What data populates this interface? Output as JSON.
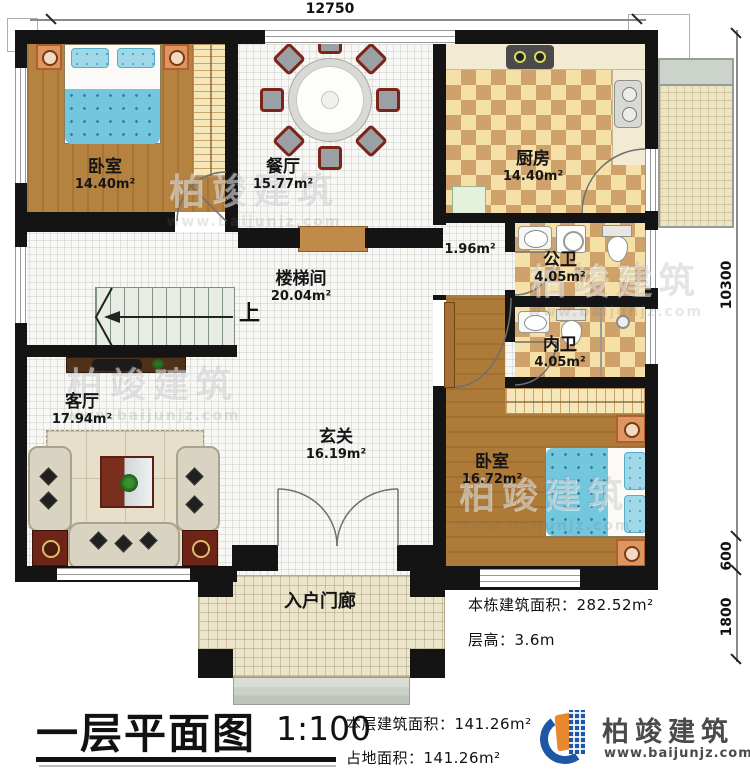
{
  "plan": {
    "dimensions": {
      "top": "12750",
      "right_total": "10300",
      "right_600": "600",
      "right_1800": "1800"
    },
    "stairs_up_label": "上",
    "rooms": {
      "bedroom1": {
        "name": "卧室",
        "area": "14.40m²"
      },
      "dining": {
        "name": "餐厅",
        "area": "15.77m²"
      },
      "kitchen": {
        "name": "厨房",
        "area": "14.40m²"
      },
      "corridor": {
        "area": "1.96m²"
      },
      "public_bath": {
        "name": "公卫",
        "area": "4.05m²"
      },
      "private_bath": {
        "name": "内卫",
        "area": "4.05m²"
      },
      "stairwell": {
        "name": "楼梯间",
        "area": "20.04m²"
      },
      "living": {
        "name": "客厅",
        "area": "17.94m²"
      },
      "foyer": {
        "name": "玄关",
        "area": "16.19m²"
      },
      "bedroom2": {
        "name": "卧室",
        "area": "16.72m²"
      },
      "porch": {
        "name": "入户门廊"
      }
    }
  },
  "notes": {
    "building_area_label": "本栋建筑面积：",
    "building_area_value": "282.52m²",
    "floor_height_label": "层高：",
    "floor_height_value": "3.6m"
  },
  "footer": {
    "title": "一层平面图",
    "scale": "1:100",
    "floor_area_label": "本层建筑面积：",
    "floor_area_value": "141.26m²",
    "land_area_label": "占地面积：",
    "land_area_value": "141.26m²"
  },
  "watermark": {
    "brand": "柏竣建筑",
    "url": "www.baijunjz.com"
  },
  "logo": {
    "brand": "柏竣建筑",
    "url": "www.baijunjz.com"
  },
  "colors": {
    "wall": "#141414",
    "floor_tile": "#f7f8f5",
    "wood": "#b5823f",
    "wood2": "#ad7a38",
    "checker_light": "#f5e0a8",
    "checker_dark": "#d0a26b",
    "counter": "#f3ead3",
    "bed_blue": "#72c6de",
    "pillow_blue": "#9fd8e8",
    "rug": "#e6dfca",
    "sofa": "#d9d3c1",
    "table_red": "#7a2e1d",
    "orange_stand": "#dd9660",
    "porch_tile": "#ece5c9",
    "balcony_top": "#ccd3cb",
    "stairs": "#e7ede5",
    "logo_blue": "#1d57a6",
    "logo_orange": "#e8872b"
  }
}
